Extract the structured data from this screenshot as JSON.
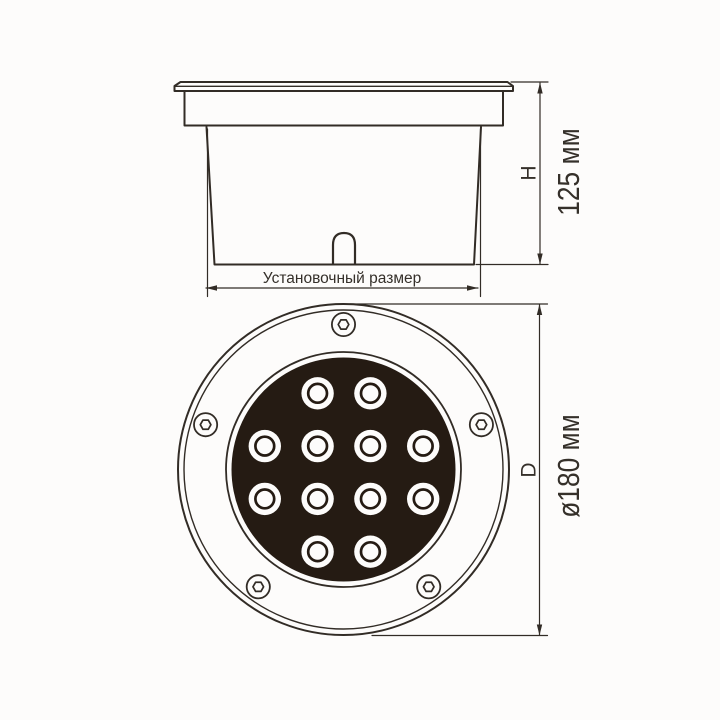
{
  "page": {
    "background": "#fdfcfb",
    "line_color": "#322c26",
    "face_color": "#251b13"
  },
  "side_view": {
    "description": "side section view of recessed luminaire body",
    "labels": {
      "height_letter": "H",
      "height_value": "125 мм",
      "install_size": "Установочный размер"
    }
  },
  "front_view": {
    "description": "front view of round ground light",
    "labels": {
      "diameter_letter": "D",
      "diameter_value": "ø180 мм"
    },
    "led_count": 12,
    "led_rows": [
      2,
      4,
      4,
      2
    ],
    "led_pattern": [
      [
        1,
        2
      ],
      [
        0,
        1,
        2,
        3
      ],
      [
        0,
        1,
        2,
        3
      ],
      [
        1,
        2
      ]
    ],
    "led_grid": {
      "cx": 344,
      "cy": 472.5,
      "step": 52.8,
      "outer_r": 16.2,
      "ring_r": 9.4,
      "ring_w": 2.7
    },
    "screws": {
      "count": 5,
      "angles_deg": [
        90,
        162,
        234,
        306,
        18
      ],
      "orbit_r": 145,
      "cx": 343.5,
      "cy": 469.5,
      "outer_r": 11.6,
      "hex_r": 5.3
    },
    "face": {
      "cx": 343.5,
      "cy": 469.5,
      "outer_r": 165.5,
      "inner_rim_r": 159.5,
      "ring_r": 117.5,
      "disc_r": 112
    }
  }
}
